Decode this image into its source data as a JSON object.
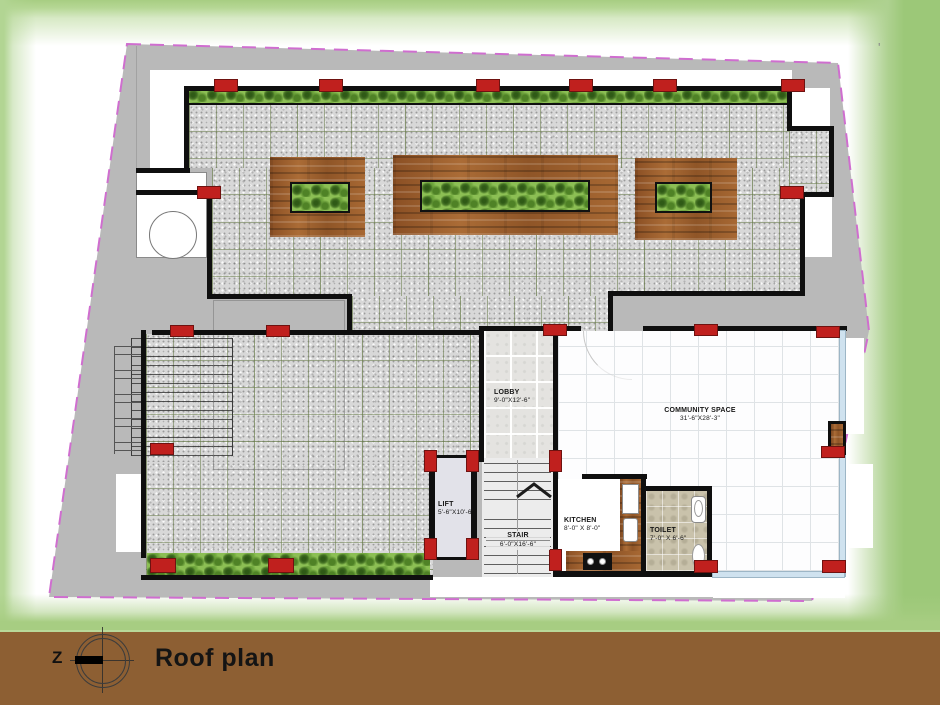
{
  "title": "Roof plan",
  "north": {
    "label": "Z"
  },
  "drawing": {
    "type": "architectural-roof-plan",
    "rooms": [
      {
        "name": "LOBBY",
        "dims": "9'-0\"X12'-6\""
      },
      {
        "name": "COMMUNITY SPACE",
        "dims": "31'-6\"X28'-3\""
      },
      {
        "name": "LIFT",
        "dims": "5'-6\"X10'-6\""
      },
      {
        "name": "STAIR",
        "dims": "6'-0\"X16'-6\""
      },
      {
        "name": "KITCHEN",
        "dims": "8'-0\" X 8'-0\""
      },
      {
        "name": "TOILET",
        "dims": "7'-0\" X 6'-6\""
      }
    ],
    "colors": {
      "site_gray": "#b9b9b9",
      "boundary_pink": "#cf6ecf",
      "column_red": "#c0201e",
      "hedge_green": "#8cbf54",
      "wood_brown": "#9a5d2c",
      "glass_blue": "#cfe2ef",
      "footer_brown": "#8d5f33",
      "frame_green": "#a7cd82"
    }
  },
  "stray_mark": "'"
}
